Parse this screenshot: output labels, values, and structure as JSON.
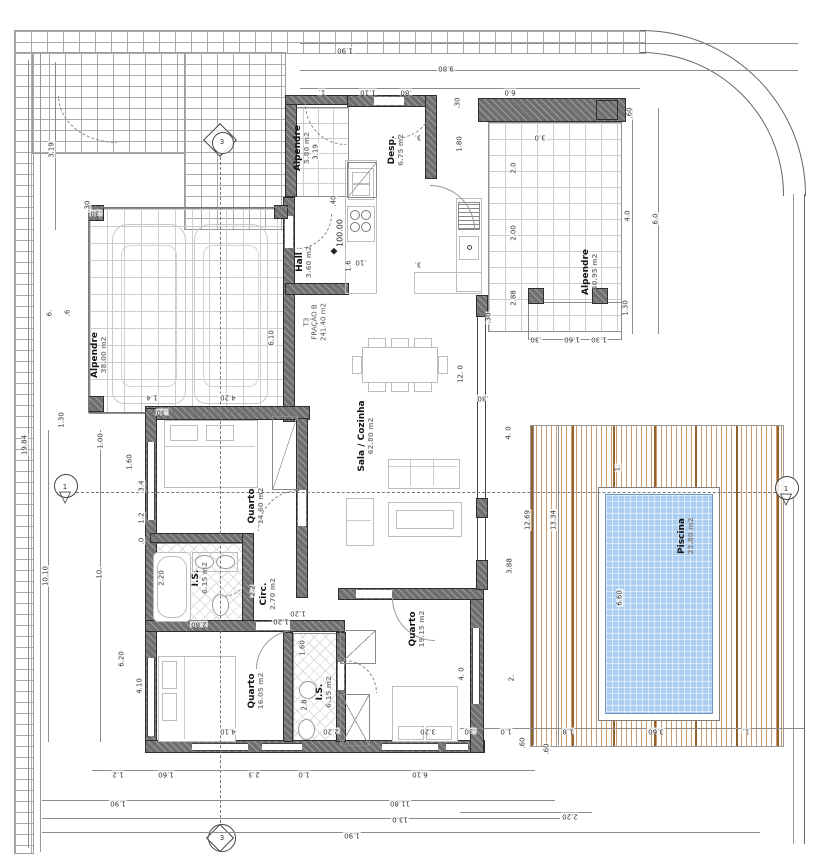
{
  "meta": {
    "width": 816,
    "height": 856,
    "drawing_type": "architectural floor plan"
  },
  "colors": {
    "wall": "#6f6f6f",
    "tile_line": "#cdcdcd",
    "brick_line": "#ababab",
    "deck_plank": "#c48a55",
    "deck_plank_dark": "#8f5a23",
    "pool_water": "#aacdf0",
    "dim_text": "#333333"
  },
  "unit": {
    "code": "T3",
    "fraction": "FRAÇÃO B",
    "area": "241.40 m2"
  },
  "level_mark": "100.00",
  "markers": {
    "vertical": "3",
    "horizontal": "1"
  },
  "rooms": [
    {
      "name": "Alpendre",
      "area": "38.00 m2"
    },
    {
      "name": "Alpendre",
      "area": "5.80 m2"
    },
    {
      "name": "Desp.",
      "area": "6.75 m2"
    },
    {
      "name": "Hall",
      "area": "3.60 m2"
    },
    {
      "name": "Sala / Cozinha",
      "area": "62.80 m2"
    },
    {
      "name": "Alpendre",
      "area": "40.95 m2"
    },
    {
      "name": "Quarto",
      "area": "14.60 m2"
    },
    {
      "name": "I.S.",
      "area": "6.15 m2"
    },
    {
      "name": "Circ.",
      "area": "2.70 m2"
    },
    {
      "name": "Quarto",
      "area": "16.05 m2"
    },
    {
      "name": "I.S.",
      "area": "6.15 m2"
    },
    {
      "name": "Quarto",
      "area": "19.15 m2"
    },
    {
      "name": "Piscina",
      "area": "23.80 m2"
    }
  ],
  "dimensions": [
    {
      "t": "1.90",
      "x": 345,
      "y": 50,
      "r": 180
    },
    {
      "t": "9.80",
      "x": 446,
      "y": 68,
      "r": 180
    },
    {
      "t": "1.",
      "x": 322,
      "y": 92,
      "r": 180
    },
    {
      "t": "1.10",
      "x": 368,
      "y": 92,
      "r": 180
    },
    {
      "t": ".80",
      "x": 406,
      "y": 92,
      "r": 180
    },
    {
      "t": "6.0",
      "x": 510,
      "y": 92,
      "r": 180
    },
    {
      "t": ".60",
      "x": 630,
      "y": 113,
      "r": 90
    },
    {
      "t": "3.0",
      "x": 540,
      "y": 137,
      "r": 180
    },
    {
      "t": "2.0",
      "x": 514,
      "y": 168,
      "r": 90
    },
    {
      "t": "2.00",
      "x": 514,
      "y": 233,
      "r": 90
    },
    {
      "t": "2.88",
      "x": 514,
      "y": 298,
      "r": 90
    },
    {
      "t": "4.0",
      "x": 628,
      "y": 216,
      "r": 90
    },
    {
      "t": "6.0",
      "x": 656,
      "y": 219,
      "r": 90
    },
    {
      "t": "1.30",
      "x": 626,
      "y": 308,
      "r": 90
    },
    {
      "t": ".30",
      "x": 536,
      "y": 339,
      "r": 180
    },
    {
      "t": "1.60",
      "x": 572,
      "y": 339,
      "r": 180
    },
    {
      "t": "1.30",
      "x": 599,
      "y": 339,
      "r": 180
    },
    {
      "t": ".30",
      "x": 489,
      "y": 318,
      "r": 90
    },
    {
      "t": "19.84",
      "x": 25,
      "y": 445,
      "r": 90
    },
    {
      "t": "3.19",
      "x": 52,
      "y": 150,
      "r": 90
    },
    {
      "t": "6.",
      "x": 50,
      "y": 313,
      "r": 90
    },
    {
      "t": ".6",
      "x": 68,
      "y": 313,
      "r": 90
    },
    {
      "t": "1.30",
      "x": 62,
      "y": 420,
      "r": 90
    },
    {
      "t": ".30",
      "x": 88,
      "y": 206,
      "r": 90
    },
    {
      "t": "10.10",
      "x": 46,
      "y": 576,
      "r": 90
    },
    {
      "t": "10.",
      "x": 100,
      "y": 573,
      "r": 90
    },
    {
      "t": "6.20",
      "x": 122,
      "y": 659,
      "r": 90
    },
    {
      "t": "4.10",
      "x": 140,
      "y": 686,
      "r": 90
    },
    {
      "t": "1.60",
      "x": 130,
      "y": 462,
      "r": 90
    },
    {
      "t": "3.4",
      "x": 142,
      "y": 486,
      "r": 90
    },
    {
      "t": "1.2",
      "x": 142,
      "y": 518,
      "r": 90
    },
    {
      "t": ".0",
      "x": 142,
      "y": 541,
      "r": 90
    },
    {
      "t": "1.00",
      "x": 101,
      "y": 441,
      "r": 90
    },
    {
      "t": "1.2",
      "x": 118,
      "y": 774,
      "r": 180
    },
    {
      "t": "1.60",
      "x": 166,
      "y": 774,
      "r": 180
    },
    {
      "t": "2.3",
      "x": 254,
      "y": 774,
      "r": 180
    },
    {
      "t": "1.0",
      "x": 304,
      "y": 774,
      "r": 180
    },
    {
      "t": "6.10",
      "x": 420,
      "y": 774,
      "r": 180
    },
    {
      "t": "1.90",
      "x": 118,
      "y": 803,
      "r": 180
    },
    {
      "t": "11.80",
      "x": 400,
      "y": 803,
      "r": 180
    },
    {
      "t": "13.0",
      "x": 400,
      "y": 819,
      "r": 180
    },
    {
      "t": "1.90",
      "x": 352,
      "y": 835,
      "r": 180
    },
    {
      "t": "2.20",
      "x": 570,
      "y": 816,
      "r": 180
    },
    {
      "t": ".30",
      "x": 470,
      "y": 731,
      "r": 180
    },
    {
      "t": "1.0",
      "x": 506,
      "y": 731,
      "r": 180
    },
    {
      "t": ".60",
      "x": 523,
      "y": 743,
      "r": 90
    },
    {
      "t": ".60",
      "x": 547,
      "y": 749,
      "r": 90
    },
    {
      "t": "1.8",
      "x": 568,
      "y": 731,
      "r": 180
    },
    {
      "t": "3.60",
      "x": 656,
      "y": 731,
      "r": 180
    },
    {
      "t": "1.",
      "x": 746,
      "y": 731,
      "r": 180
    },
    {
      "t": "6.10",
      "x": 272,
      "y": 338,
      "r": 90
    },
    {
      "t": "4.20",
      "x": 228,
      "y": 397,
      "r": 180
    },
    {
      "t": "1.4",
      "x": 152,
      "y": 397,
      "r": 180
    },
    {
      "t": ".30",
      "x": 162,
      "y": 412,
      "r": 180
    },
    {
      "t": ".30",
      "x": 96,
      "y": 213,
      "r": 180
    },
    {
      "t": "3.19",
      "x": 316,
      "y": 152,
      "r": 90
    },
    {
      "t": ".40",
      "x": 334,
      "y": 201,
      "r": 90
    },
    {
      "t": "1.6",
      "x": 349,
      "y": 266,
      "r": 90
    },
    {
      "t": ".10",
      "x": 361,
      "y": 262,
      "r": 180
    },
    {
      "t": "3.",
      "x": 418,
      "y": 264,
      "r": 180
    },
    {
      "t": "1.80",
      "x": 460,
      "y": 144,
      "r": 90
    },
    {
      "t": "3.",
      "x": 418,
      "y": 137,
      "r": 180
    },
    {
      "t": ".30",
      "x": 458,
      "y": 103,
      "r": 90
    },
    {
      "t": "12. 0",
      "x": 461,
      "y": 374,
      "r": 90
    },
    {
      "t": ".30",
      "x": 483,
      "y": 398,
      "r": 180
    },
    {
      "t": "3.88",
      "x": 510,
      "y": 566,
      "r": 90
    },
    {
      "t": "4. 0",
      "x": 509,
      "y": 433,
      "r": 90
    },
    {
      "t": "2.20",
      "x": 162,
      "y": 578,
      "r": 90
    },
    {
      "t": "2.2",
      "x": 253,
      "y": 591,
      "r": 90
    },
    {
      "t": "1.20",
      "x": 281,
      "y": 621,
      "r": 180
    },
    {
      "t": "2.80",
      "x": 199,
      "y": 624,
      "r": 180
    },
    {
      "t": "1.20",
      "x": 298,
      "y": 613,
      "r": 180
    },
    {
      "t": "1.60",
      "x": 303,
      "y": 648,
      "r": 90
    },
    {
      "t": "2.8",
      "x": 305,
      "y": 705,
      "r": 90
    },
    {
      "t": "4.10",
      "x": 228,
      "y": 731,
      "r": 180
    },
    {
      "t": "2.20",
      "x": 331,
      "y": 731,
      "r": 180
    },
    {
      "t": "3.20",
      "x": 428,
      "y": 731,
      "r": 180
    },
    {
      "t": "4. 0",
      "x": 462,
      "y": 674,
      "r": 90
    },
    {
      "t": "2.",
      "x": 512,
      "y": 678,
      "r": 90
    },
    {
      "t": "12.69",
      "x": 528,
      "y": 520,
      "r": 90
    },
    {
      "t": "13.34",
      "x": 554,
      "y": 520,
      "r": 90
    },
    {
      "t": "6.60",
      "x": 620,
      "y": 598,
      "r": 90
    },
    {
      "t": "1.",
      "x": 618,
      "y": 468,
      "r": 90
    }
  ]
}
